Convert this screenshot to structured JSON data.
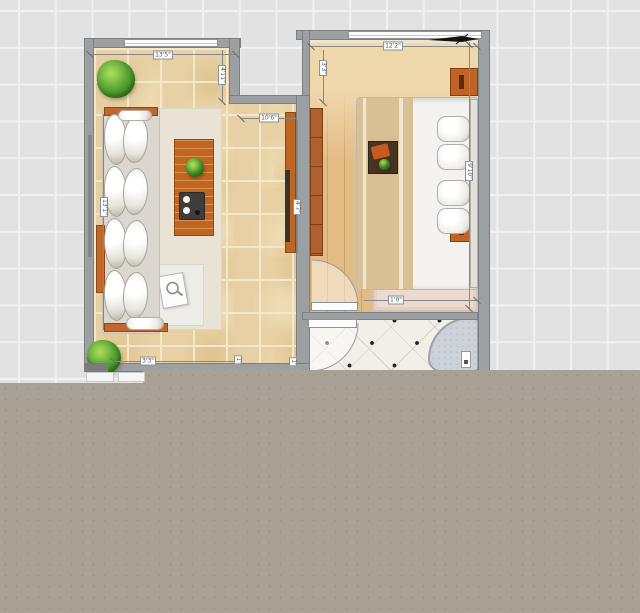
{
  "app": {
    "view": "floor-plan-canvas"
  },
  "palette": {
    "canvas_bg": "#e2e2e3",
    "grid_line": "#f1f1f2",
    "unloaded_overlay": "#a8a195",
    "wall": "#9da0a2",
    "living_tile": "#e7d1a4",
    "bedroom_wood": "#e2bc85",
    "bath_tile": "#f2efe8",
    "furniture_wood": "#bf6426",
    "rug_pink": "#eddacf",
    "tub": "#ccd3d8",
    "plant_green": "#5ba636"
  },
  "dim_labels": {
    "living_width": "13'5\"",
    "living_entry": "4'11\"",
    "living_side": "13'1\"",
    "tv_wall": "10'6\"",
    "tv_side": "4'7\"",
    "living_bottom": "3'3\"",
    "bottom_a": "1'",
    "bottom_b": "1'",
    "bedroom_width": "12'2\"",
    "bedroom_left": "3'3\"",
    "bedroom_side": "9'10\"",
    "rug_width": "1'0\""
  }
}
